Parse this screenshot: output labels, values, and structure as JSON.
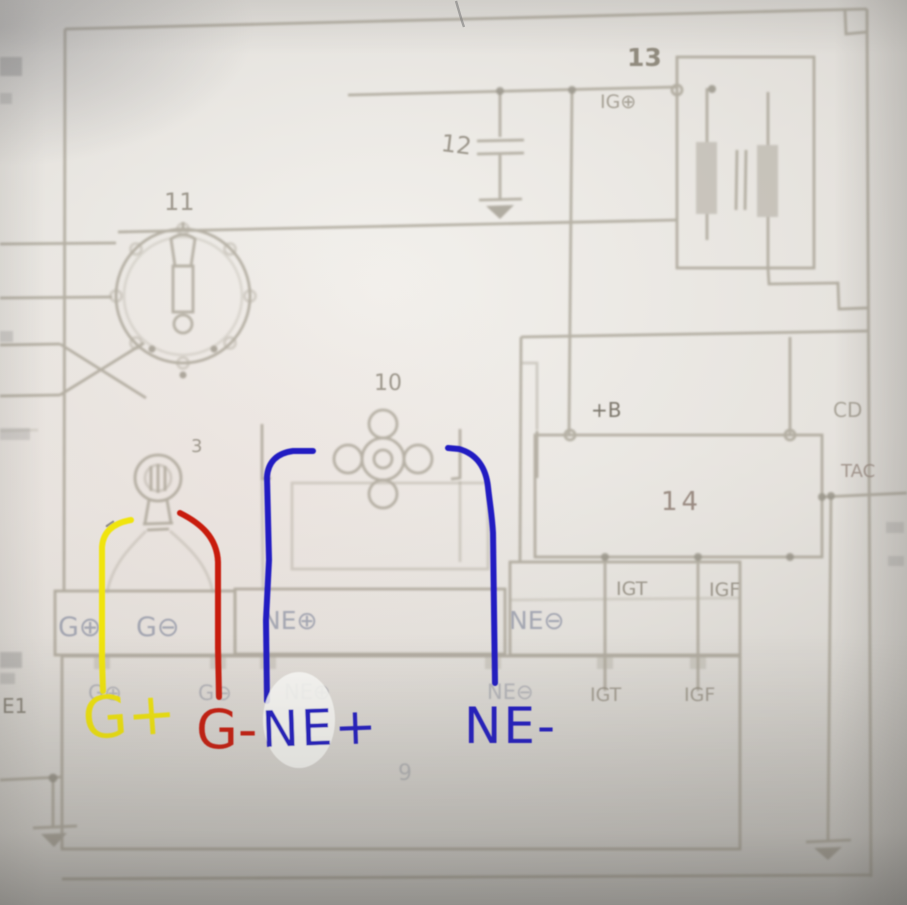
{
  "colors": {
    "yellow": "#f0e411",
    "red": "#c81c10",
    "blue": "#201dc2",
    "ink": "#948e7e",
    "paper": "#e7e4df"
  },
  "handwritten": {
    "g_plus": "G+",
    "g_minus": "G-",
    "ne_plus": "NE+",
    "ne_minus": "NE-"
  },
  "labels": {
    "distributor_no": "11",
    "condenser_no": "12",
    "coil_no": "13",
    "igniter_no": "14",
    "reluctor_no": "10",
    "pickup_no": "3",
    "ecu_no": "9",
    "ig": "IG⊕",
    "plus_b": "+B",
    "cd": "CD",
    "tac": "TAC",
    "e1": "E1",
    "igt": "IGT",
    "igf": "IGF",
    "g_plus": "G⊕",
    "g_minus": "G⊖",
    "ne_plus": "NE⊕",
    "ne_minus": "NE⊖"
  }
}
